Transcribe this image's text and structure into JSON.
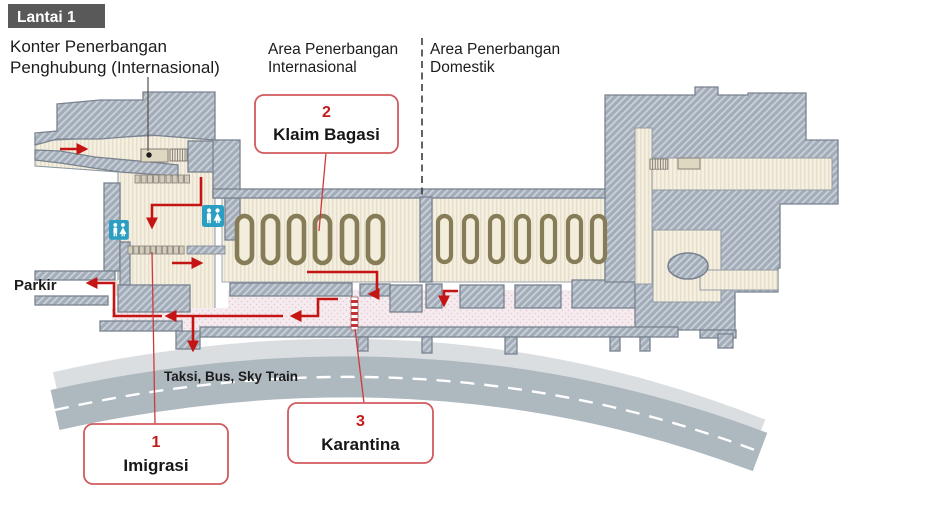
{
  "floor_badge": "Lantai 1",
  "labels": {
    "transfer_counter_line1": "Konter Penerbangan",
    "transfer_counter_line2": "Penghubung (Internasional)",
    "area_international_line1": "Area Penerbangan",
    "area_international_line2": "Internasional",
    "area_domestic_line1": "Area Penerbangan",
    "area_domestic_line2": "Domestik",
    "parking": "Parkir",
    "ground_transport": "Taksi, Bus, Sky Train"
  },
  "callouts": [
    {
      "number": "1",
      "label": "Imigrasi"
    },
    {
      "number": "2",
      "label": "Klaim Bagasi"
    },
    {
      "number": "3",
      "label": "Karantina"
    }
  ],
  "map": {
    "floor": "1",
    "international_baggage_carousels": 6,
    "domestic_baggage_carousels": 7,
    "restroom_count": 2
  },
  "colors": {
    "badge_bg": "#595959",
    "wall": "#a3adba",
    "floor": "#f5efe0",
    "public_area": "#f3e4e9",
    "carousel_ring": "#867d58",
    "restroom_blue": "#2b9fc3",
    "flow_arrow_red": "#c41414",
    "callout_border": "#d05a5f",
    "road_gray": "#aeb8bf",
    "sidewalk_gray": "#dbdee0"
  }
}
